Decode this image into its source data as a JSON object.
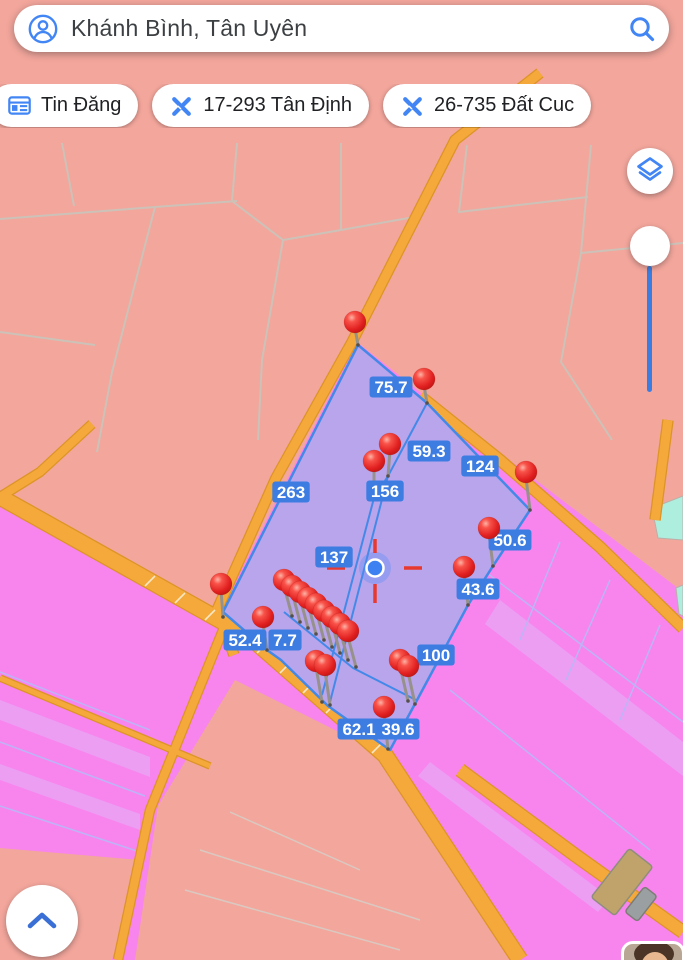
{
  "search_bar": {
    "query": "Khánh Bình, Tân Uyên"
  },
  "chips": [
    {
      "label": "Tin Đăng",
      "icon": "listings-icon"
    },
    {
      "label": "17-293 Tân Định",
      "icon": "survey-tools-icon"
    },
    {
      "label": "26-735 Đất Cuc",
      "icon": "survey-tools-icon"
    }
  ],
  "controls": {
    "layers_button": "layers-icon",
    "zoom_slider_position": "top",
    "expand_button": "chevron-up-icon"
  },
  "map": {
    "colors": {
      "salmon": "#f3a69c",
      "magenta": "#f884ee",
      "stripe": "#ec9ef3",
      "hairline": "#bdb4f6",
      "mesh": "#ccc2b8",
      "teal": "#aeeede",
      "road": "#f4a93a",
      "road_edge": "#dd9426",
      "tick": "#f8e6c4",
      "parcel": "#b9a5ec",
      "parcel_border": "#4489e8",
      "label_bg": "#3d7de2",
      "label_text": "#ffffff",
      "pin_red": "#e01f1f",
      "marker_blue": "#3d80f2",
      "crosshair_red": "#e8392e"
    },
    "measurement_labels": [
      {
        "t": "75.7",
        "x": 391,
        "y": 387
      },
      {
        "t": "59.3",
        "x": 429,
        "y": 451
      },
      {
        "t": "124",
        "x": 480,
        "y": 466
      },
      {
        "t": "263",
        "x": 291,
        "y": 492
      },
      {
        "t": "156",
        "x": 385,
        "y": 491
      },
      {
        "t": "137",
        "x": 334,
        "y": 557
      },
      {
        "t": "50.6",
        "x": 510,
        "y": 540
      },
      {
        "t": "43.6",
        "x": 478,
        "y": 589
      },
      {
        "t": "52.4",
        "x": 245,
        "y": 640
      },
      {
        "t": "7.7",
        "x": 285,
        "y": 640
      },
      {
        "t": "100",
        "x": 436,
        "y": 655
      },
      {
        "t": "62.1",
        "x": 359,
        "y": 729
      },
      {
        "t": "39.6",
        "x": 398,
        "y": 729
      }
    ],
    "pins": [
      {
        "x": 355,
        "y": 322,
        "dx": 3,
        "len": 23
      },
      {
        "x": 424,
        "y": 379,
        "dx": 3,
        "len": 24
      },
      {
        "x": 526,
        "y": 472,
        "dx": 4,
        "len": 38
      },
      {
        "x": 489,
        "y": 528,
        "dx": 4,
        "len": 38
      },
      {
        "x": 464,
        "y": 567,
        "dx": 4,
        "len": 38
      },
      {
        "x": 221,
        "y": 584,
        "dx": 2,
        "len": 33
      },
      {
        "x": 263,
        "y": 617,
        "dx": 4,
        "len": 33
      },
      {
        "x": 316,
        "y": 661,
        "dx": 6,
        "len": 41
      },
      {
        "x": 325,
        "y": 665,
        "dx": 5,
        "len": 40
      },
      {
        "x": 400,
        "y": 660,
        "dx": 8,
        "len": 41
      },
      {
        "x": 408,
        "y": 666,
        "dx": 7,
        "len": 38
      },
      {
        "x": 384,
        "y": 707,
        "dx": 4,
        "len": 42
      },
      {
        "x": 390,
        "y": 444,
        "dx": -2,
        "len": 32
      },
      {
        "x": 374,
        "y": 461,
        "dx": 0,
        "len": 37
      },
      {
        "x": 284,
        "y": 580,
        "dx": 8,
        "len": 36
      },
      {
        "x": 292,
        "y": 586,
        "dx": 8,
        "len": 36
      },
      {
        "x": 300,
        "y": 592,
        "dx": 8,
        "len": 36
      },
      {
        "x": 308,
        "y": 598,
        "dx": 8,
        "len": 36
      },
      {
        "x": 316,
        "y": 604,
        "dx": 8,
        "len": 36
      },
      {
        "x": 324,
        "y": 611,
        "dx": 8,
        "len": 36
      },
      {
        "x": 332,
        "y": 617,
        "dx": 8,
        "len": 36
      },
      {
        "x": 340,
        "y": 624,
        "dx": 8,
        "len": 36
      },
      {
        "x": 348,
        "y": 631,
        "dx": 8,
        "len": 36
      }
    ],
    "location_marker": {
      "x": 375,
      "y": 568
    },
    "geometry": {
      "mesh_lines": [
        "62,143 74,206",
        "0,219 155,207 237,201",
        "237,143 232,201",
        "155,207 112,372 97,452",
        "232,201 283,240 341,230 420,216",
        "283,240 262,360 258,440",
        "341,143 341,230",
        "0,332 95,345",
        "467,145 459,212 588,197",
        "591,145 581,253 683,243",
        "581,253 561,362 612,440"
      ],
      "magenta_regions": [
        "420,392 683,592 683,960 520,960 385,755 250,637 221,610 357,342",
        "0,497 250,637 385,755 520,960 0,960"
      ],
      "stripes": [
        {
          "pts": "0,700 150,757 150,777 0,720"
        },
        {
          "pts": "0,764 140,814 140,830 0,780"
        },
        {
          "pts": "500,600 683,742 683,776 485,624"
        },
        {
          "pts": "430,762 610,898 598,912 418,776"
        }
      ],
      "hairlines": [
        {
          "pts": "0,672 150,730"
        },
        {
          "pts": "0,742 145,796"
        },
        {
          "pts": "0,806 140,852"
        },
        {
          "pts": "470,560 683,722"
        },
        {
          "pts": "450,690 650,850"
        },
        {
          "pts": "560,542 520,640"
        },
        {
          "pts": "610,580 566,680"
        },
        {
          "pts": "660,625 620,720"
        }
      ],
      "salmon_patches": [
        "235,680 385,755 520,960 135,960 158,806",
        "0,848 140,860 112,960 0,960"
      ],
      "patch_lines": [
        "200,850 420,920",
        "185,890 400,950",
        "230,812 360,870"
      ],
      "teal_parcels": [
        "652,508 683,496 683,540 658,538",
        "676,588 683,585 683,616 679,614"
      ],
      "roads": [
        {
          "pts": "0,497 250,637 385,755 520,960",
          "w": 15
        },
        {
          "pts": "540,73 455,140 352,342 276,478 217,610 234,655",
          "w": 9
        },
        {
          "pts": "420,396 500,460 600,547 683,628",
          "w": 10
        },
        {
          "pts": "225,625 150,810 118,960",
          "w": 8
        },
        {
          "pts": "0,678 210,766",
          "w": 5
        },
        {
          "pts": "460,770 575,855 683,932",
          "w": 12
        },
        {
          "pts": "668,420 655,520",
          "w": 9
        },
        {
          "pts": "92,424 40,472 0,497",
          "w": 8
        }
      ],
      "road_ticks": [
        "155,576 145,586",
        "185,593 175,603",
        "215,610 205,620",
        "245,626 235,636",
        "267,643 257,653",
        "290,663 280,673",
        "313,683 303,693",
        "336,703 326,713",
        "359,723 349,733",
        "382,743 372,753"
      ],
      "buildings": [
        {
          "x": 622,
          "y": 882,
          "w": 30,
          "h": 62,
          "r": 38,
          "c": "#bfa36b",
          "s": "#8e8e7e"
        },
        {
          "x": 641,
          "y": 904,
          "w": 16,
          "h": 32,
          "r": 38,
          "c": "#9aa0a2",
          "s": "#7d7d76"
        }
      ],
      "parcel": {
        "pts": "358,345 427,403 530,510 493,566 468,605 416,702 390,750 328,706 281,660 267,650 223,612",
        "inner": [
          "427,403 388,476",
          "388,476 374,498",
          "388,476 330,702",
          "374,498 322,695",
          "284,612 353,668 416,700"
        ]
      }
    }
  }
}
